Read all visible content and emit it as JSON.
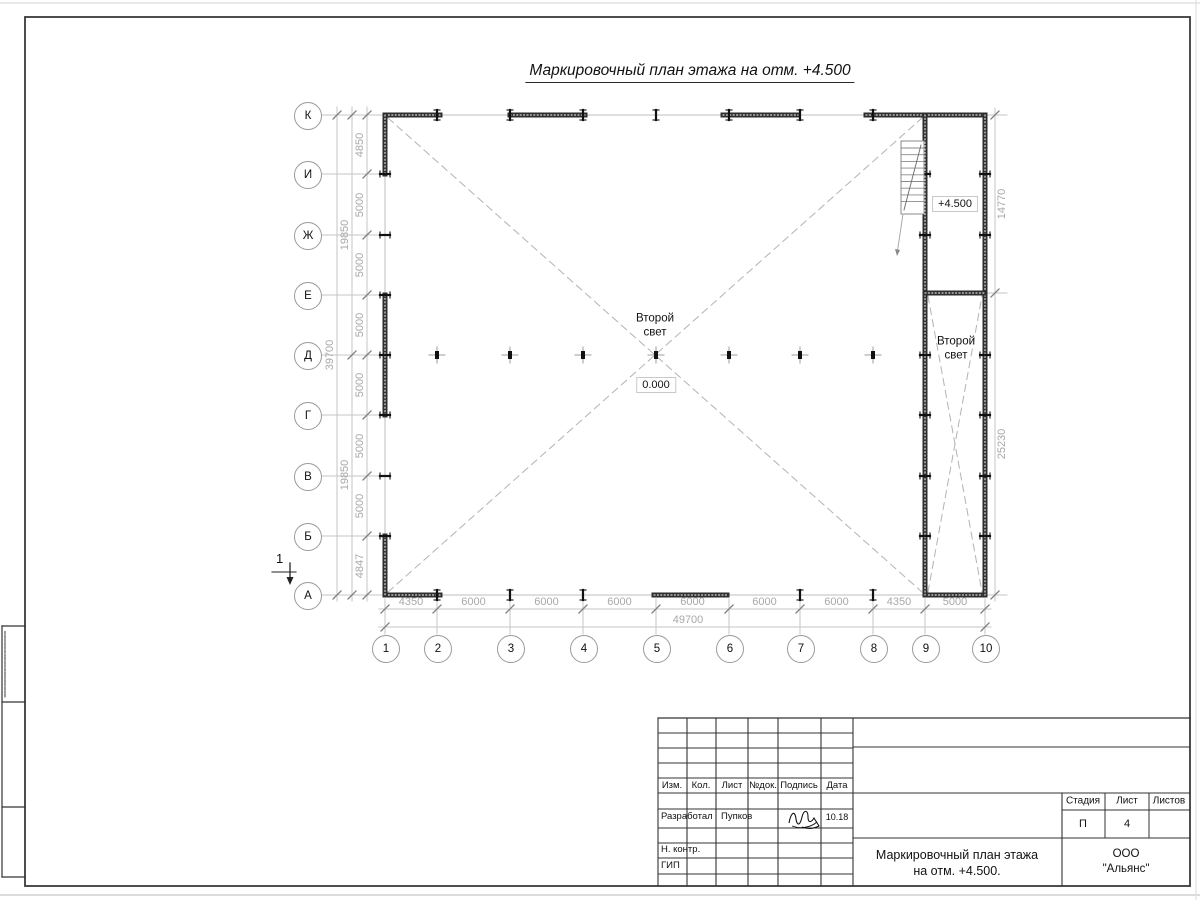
{
  "sheet": {
    "title": "Маркировочный план этажа на отм. +4.500"
  },
  "plan": {
    "row_axes": [
      "К",
      "И",
      "Ж",
      "Е",
      "Д",
      "Г",
      "В",
      "Б",
      "А"
    ],
    "col_axes": [
      "1",
      "2",
      "3",
      "4",
      "5",
      "6",
      "7",
      "8",
      "9",
      "10"
    ],
    "dim_bottom_segments": [
      "4350",
      "6000",
      "6000",
      "6000",
      "6000",
      "6000",
      "6000",
      "4350",
      "5000"
    ],
    "dim_bottom_total": "49700",
    "dim_left_segments": [
      "4850",
      "5000",
      "5000",
      "5000",
      "5000",
      "5000",
      "5000",
      "4847"
    ],
    "dim_left_groups": [
      "19850",
      "19850"
    ],
    "dim_left_total": "39700",
    "dim_right_top": "14770",
    "dim_right_bottom": "25230",
    "label_second_light_main": "Второй\nсвет",
    "label_second_light_right": "Второй\nсвет",
    "label_level_zero": "0.000",
    "label_level_plus": "+4.500",
    "section_mark": "1"
  },
  "title_block": {
    "header_cols": [
      "Изм.",
      "Кол.",
      "Лист",
      "№док.",
      "Подпись",
      "Дата"
    ],
    "developed_by_label": "Разработал",
    "developed_by_name": "Пупков",
    "developed_by_date": "10.18",
    "n_contr_label": "Н. контр.",
    "gip_label": "ГИП",
    "stage_cols": [
      "Стадия",
      "Лист",
      "Листов"
    ],
    "stage_value": "П",
    "sheet_value": "4",
    "sheets_value": "",
    "doc_title": "Маркировочный план этажа\nна отм. +4.500.",
    "organization": "ООО \"Альянс\""
  }
}
